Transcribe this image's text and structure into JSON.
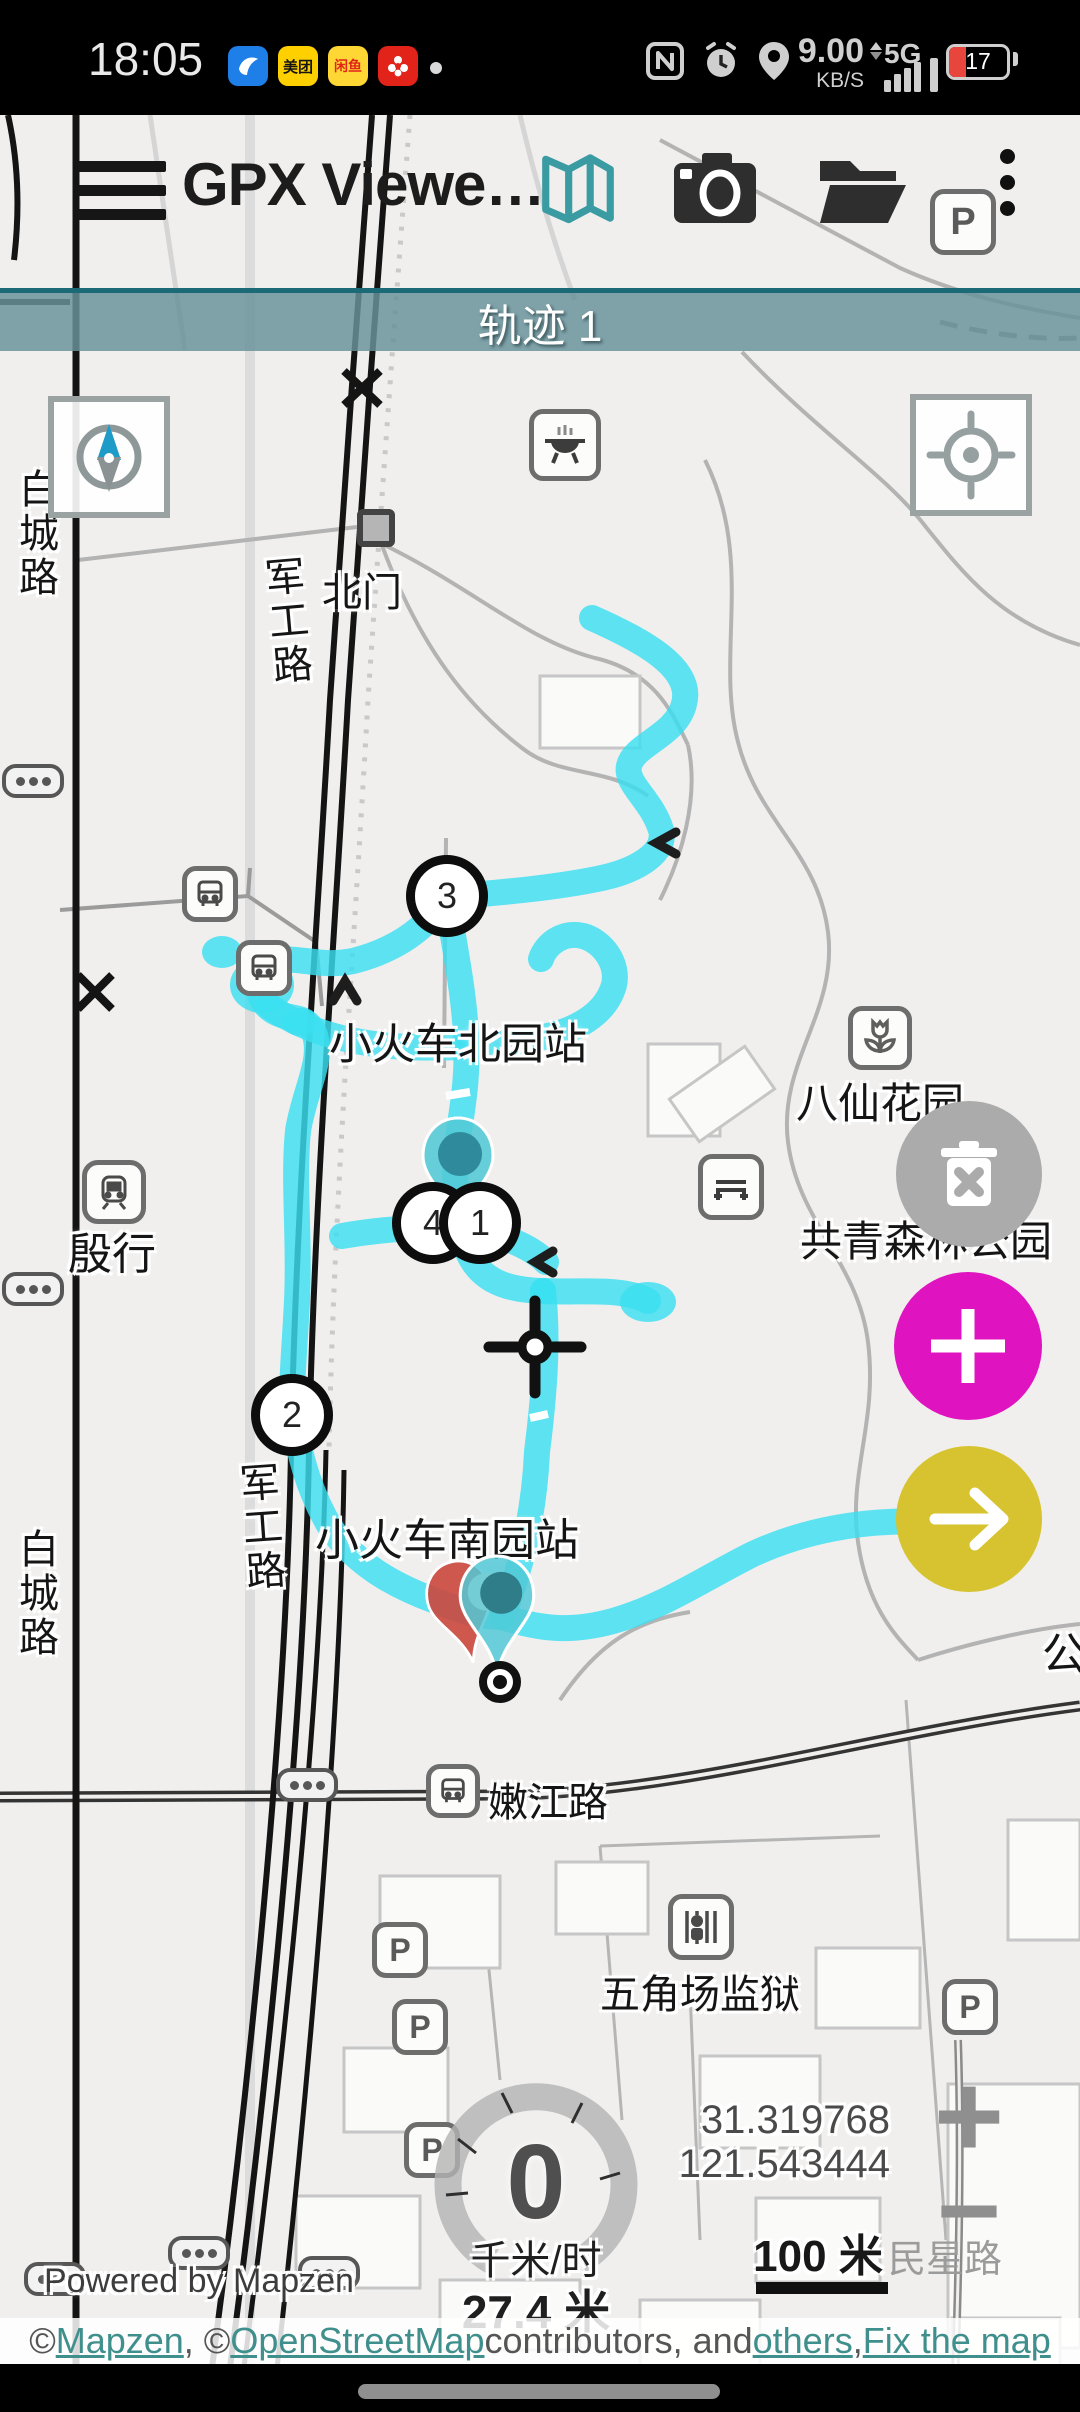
{
  "status_bar": {
    "time": "18:05",
    "network_speed": "9.00",
    "network_speed_unit": "KB/S",
    "network_type": "5G",
    "battery_level": "17",
    "accent_blue": "#1f7fe8",
    "accent_yellow": "#ffd000",
    "accent_red": "#e2231a"
  },
  "toolbar": {
    "title": "GPX Viewe…"
  },
  "track_banner": {
    "label": "轨迹 1"
  },
  "map": {
    "track_color": "#3bdff0",
    "labels": {
      "north_gate": "北门",
      "north_station": "小火车北园站",
      "south_station": "小火车南园站",
      "flower_garden": "八仙花园",
      "forest_park": "共青森林公园",
      "metro_station": "殷行",
      "nenjiang_road": "嫩江路",
      "prison": "五角场监狱",
      "minxing_road": "民星路",
      "baicheng_road_north": "白城路",
      "baicheng_road_south": "白城路",
      "jungong_road_north": "军工路",
      "jungong_road_south": "军工路",
      "park_edge": "公"
    },
    "waypoints": {
      "w1": "1",
      "w2": "2",
      "w3": "3",
      "w4": "4"
    },
    "parking_label": "P"
  },
  "hud": {
    "speed_value": "0",
    "speed_unit": "千米/时",
    "altitude": "27.4 米",
    "latitude": "31.319768",
    "longitude": "121.543444",
    "scale_label": "100 米",
    "zoom_in": "+",
    "zoom_out": "−",
    "powered_by": "Powered by Mapzen"
  },
  "attribution": {
    "prefix": "© ",
    "link_mapzen": "Mapzen",
    "mid1": ", © ",
    "link_osm": "OpenStreetMap",
    "mid2": " contributors, and ",
    "link_others": "others",
    "mid3": ", ",
    "link_fix": "Fix the map"
  }
}
